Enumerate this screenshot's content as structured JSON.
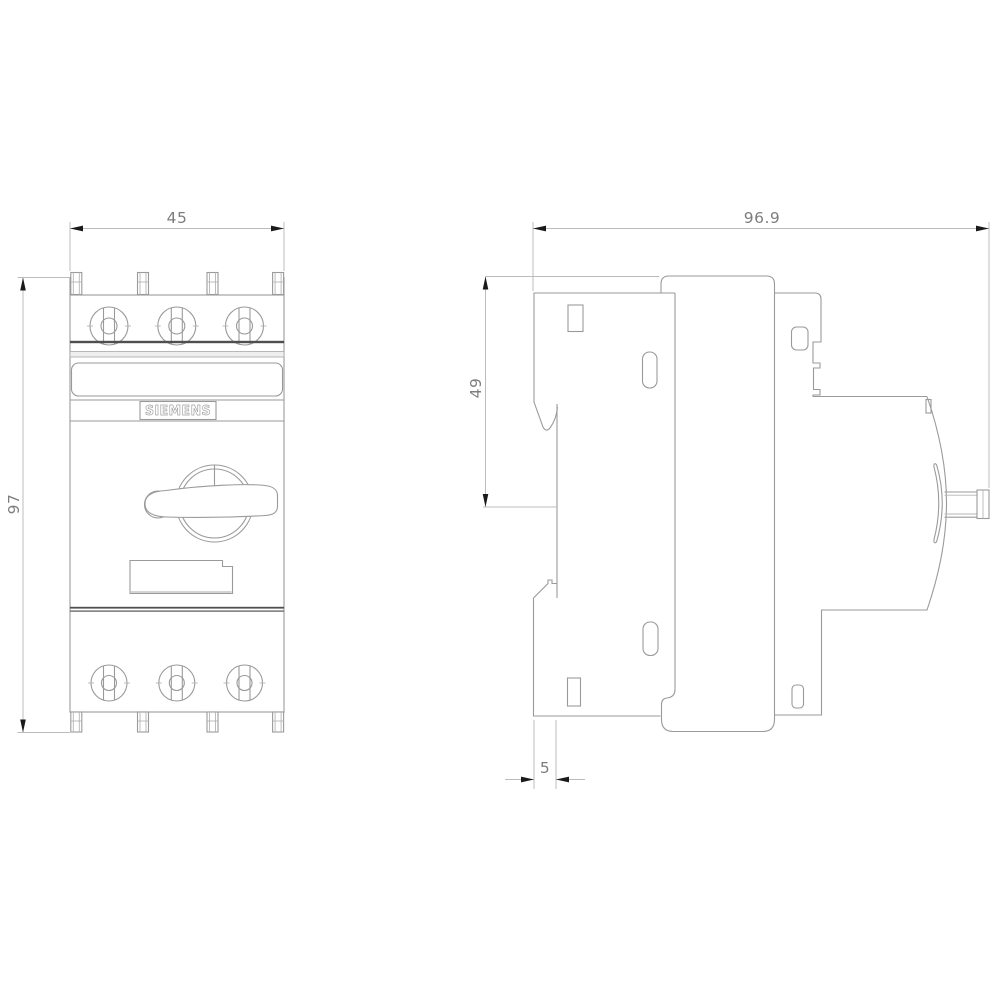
{
  "front_view": {
    "brand_label": "SIEMENS",
    "width_dim": "45",
    "height_dim": "97",
    "top_terminal_count": 3,
    "bottom_terminal_count": 3,
    "top_tab_count": 4,
    "bottom_tab_count": 4
  },
  "side_view": {
    "depth_dim": "96.9",
    "upper_height_dim": "49",
    "rail_offset_dim": "5"
  },
  "colors": {
    "background": "#ffffff",
    "outline": "#9a9a9a",
    "dark_separator": "#4f4f4f",
    "dimension_line": "#bcbcbc",
    "arrow": "#1a1a1a",
    "dimension_text": "#7d7d7d"
  }
}
